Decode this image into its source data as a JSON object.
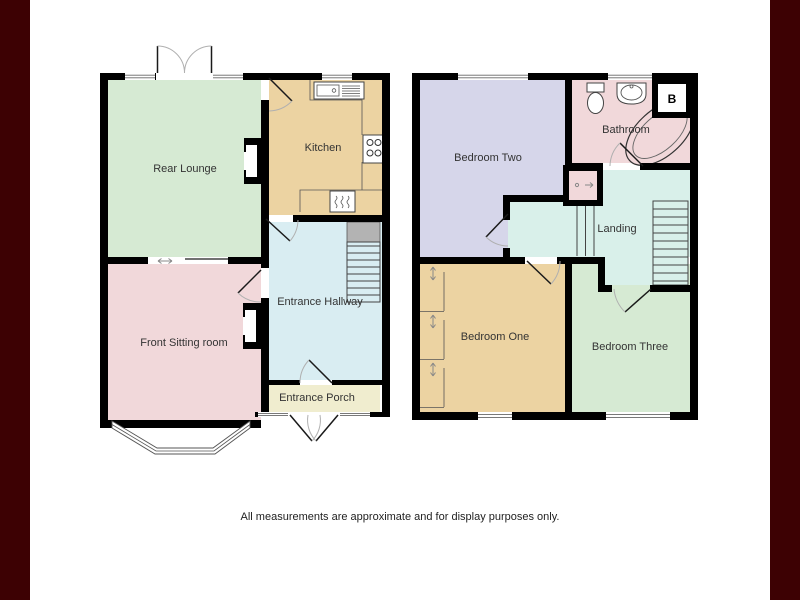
{
  "caption": "All measurements are approximate and for display purposes only.",
  "ground_floor": {
    "rear_lounge": "Rear Lounge",
    "kitchen": "Kitchen",
    "front_sitting_room": "Front Sitting room",
    "entrance_hallway": "Entrance Hallway",
    "entrance_porch": "Entrance Porch"
  },
  "first_floor": {
    "bedroom_two": "Bedroom Two",
    "bathroom": "Bathroom",
    "landing": "Landing",
    "bedroom_one": "Bedroom One",
    "bedroom_three": "Bedroom Three",
    "boiler": "B"
  },
  "colors": {
    "frame": "#3d0103",
    "wall": "#000000",
    "lounge_green": "#d6ead3",
    "kitchen_tan": "#ecd3a2",
    "sitting_pink": "#f1d8da",
    "hallway_blue": "#d9edf2",
    "porch_cream": "#f0edcf",
    "bedroom_lavender": "#d6d6ea",
    "landing_cyan": "#d9f0ea",
    "cupboard_gray": "#b3b3b3"
  }
}
